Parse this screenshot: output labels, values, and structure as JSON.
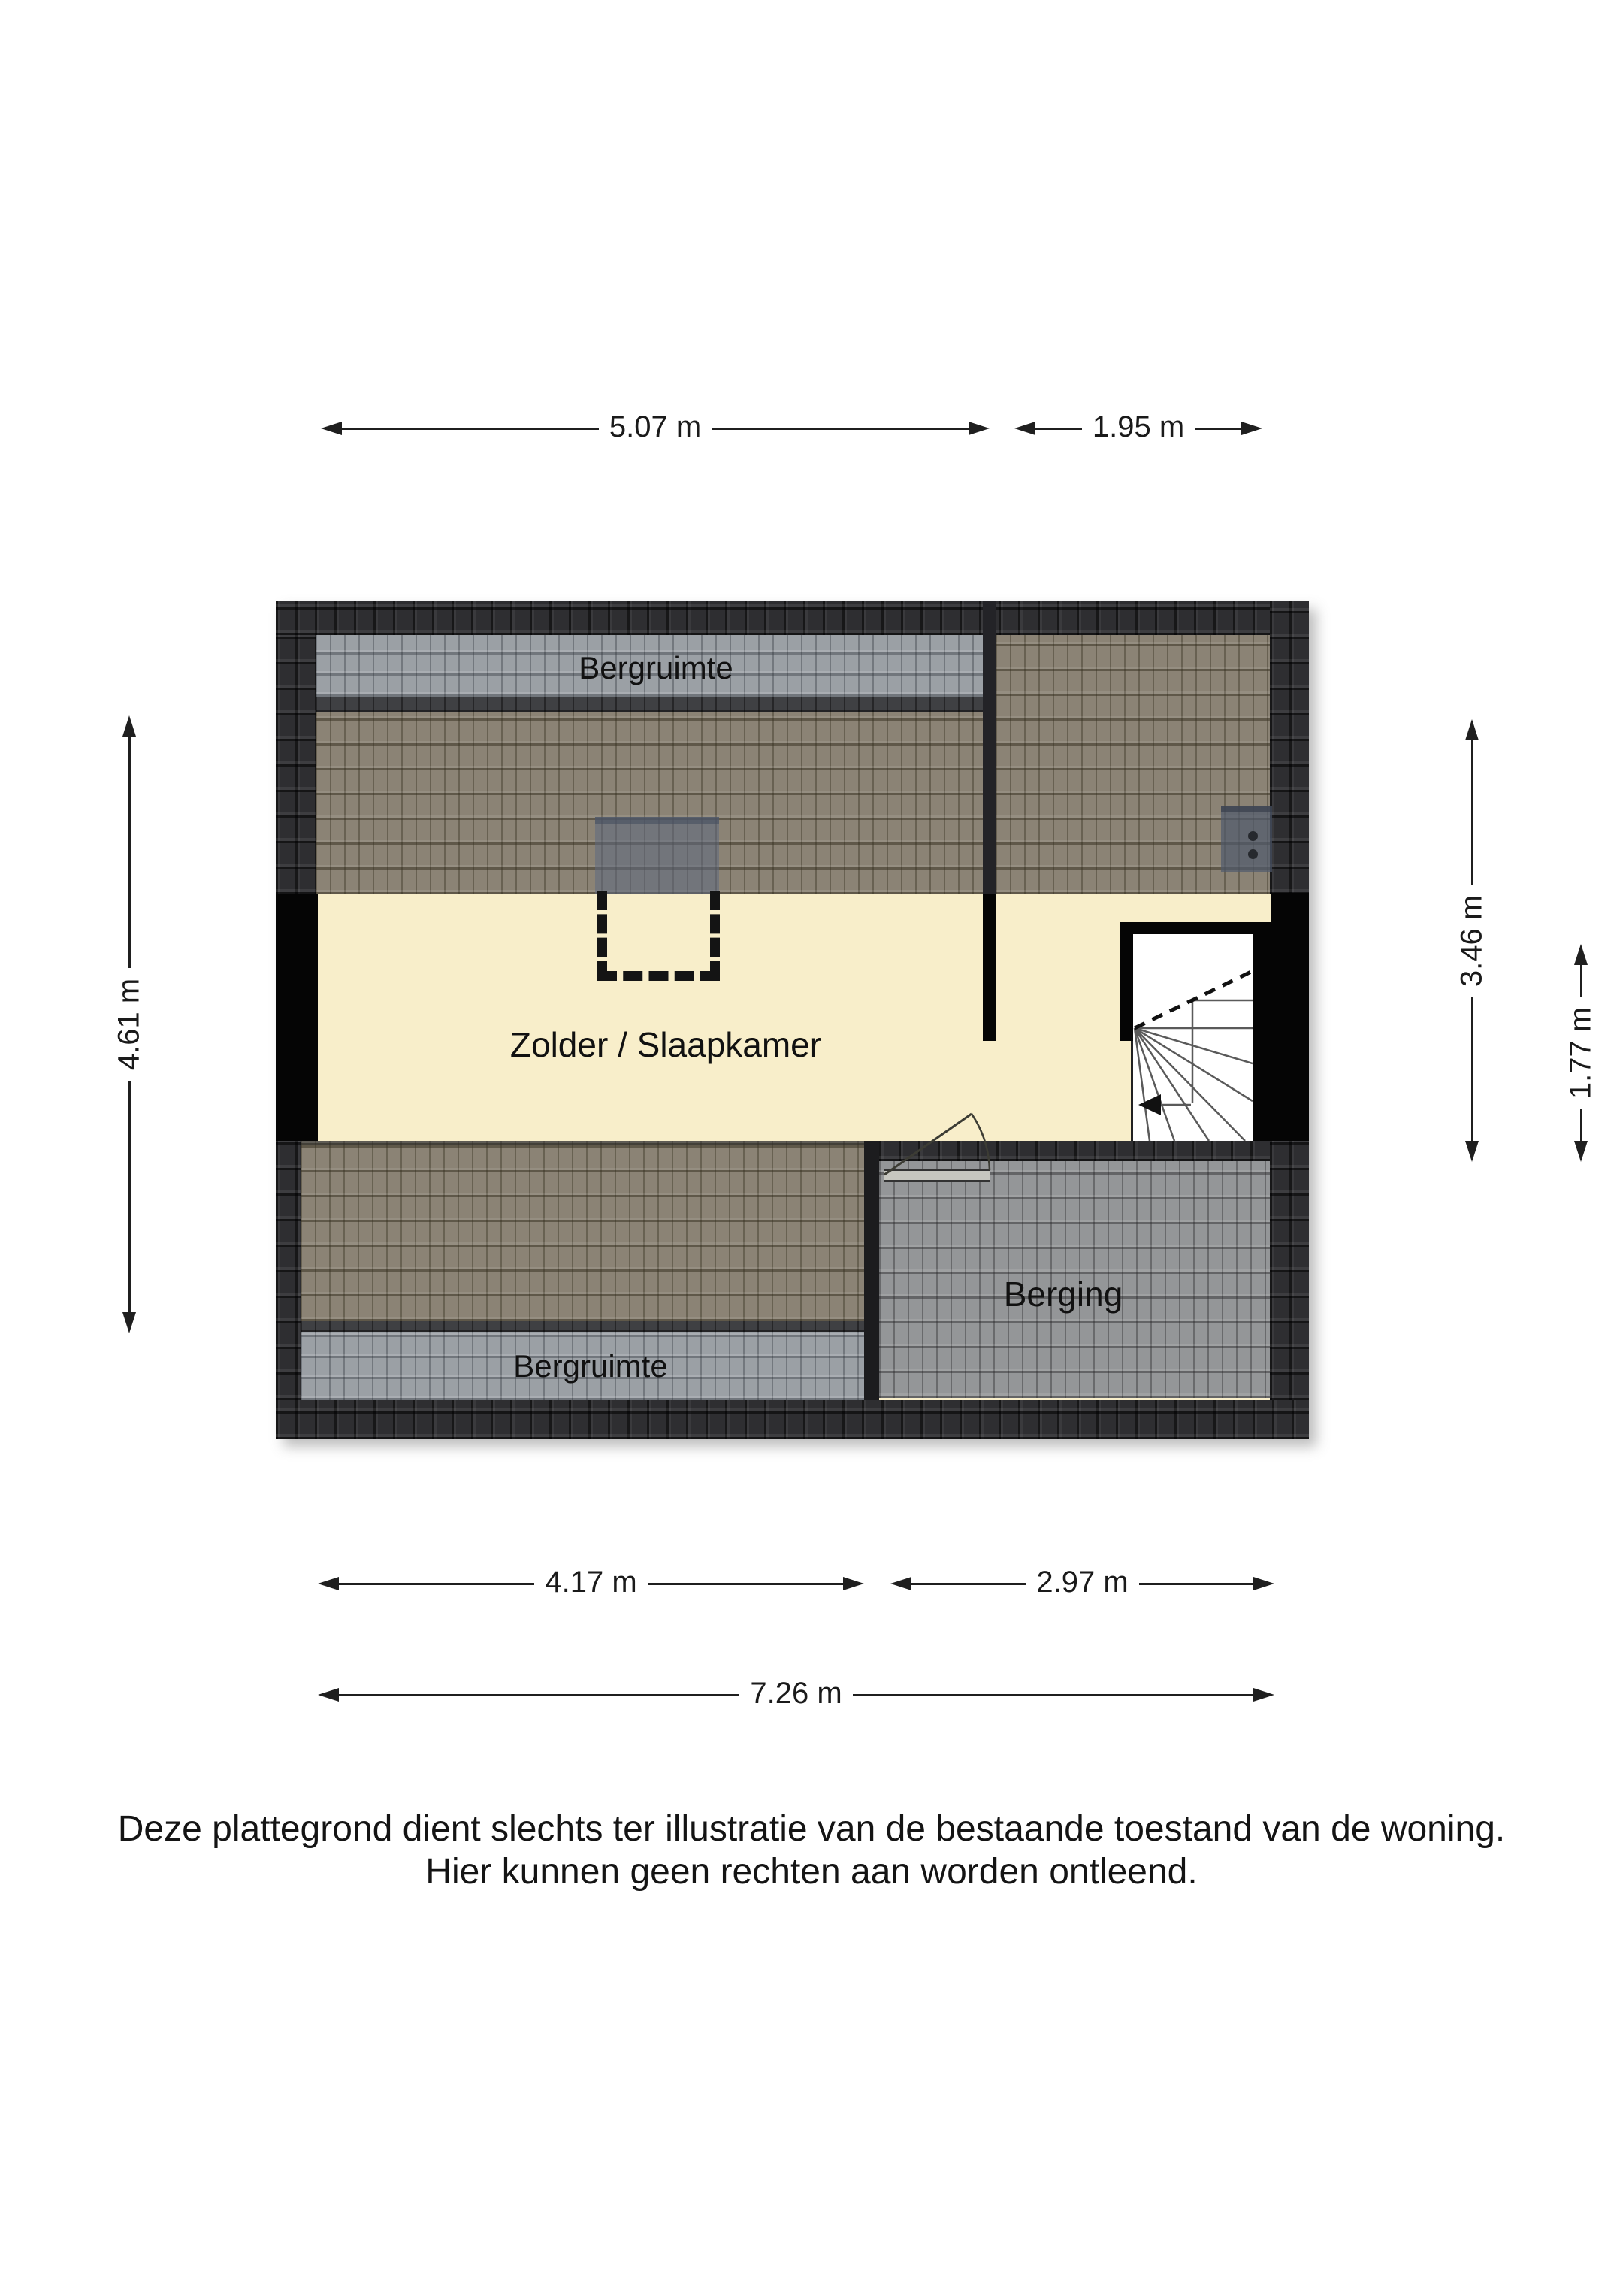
{
  "plan": {
    "rooms": {
      "bergruimte_top": "Bergruimte",
      "zolder": "Zolder / Slaapkamer",
      "berging": "Berging",
      "bergruimte_bottom": "Bergruimte"
    },
    "dims": {
      "top_left_width": "5.07 m",
      "top_right_width": "1.95 m",
      "left_height": "4.61 m",
      "right_height_upper": "3.46 m",
      "right_height_lower": "1.77 m",
      "bottom_left_width": "4.17 m",
      "bottom_right_width": "2.97 m",
      "bottom_total_width": "7.26 m"
    },
    "colors": {
      "floor": "#f8eeca",
      "roof_dark": "#2e2e31",
      "roof_brown": "#8b8375",
      "kneewall_gray": "#9ba0a6",
      "berging_gray": "#949698",
      "wall": "#050505",
      "dimension": "#1f1f1f"
    }
  },
  "disclaimer": {
    "line1": "Deze plattegrond dient slechts ter illustratie van de bestaande toestand van de woning.",
    "line2": "Hier kunnen geen rechten aan worden ontleend."
  }
}
